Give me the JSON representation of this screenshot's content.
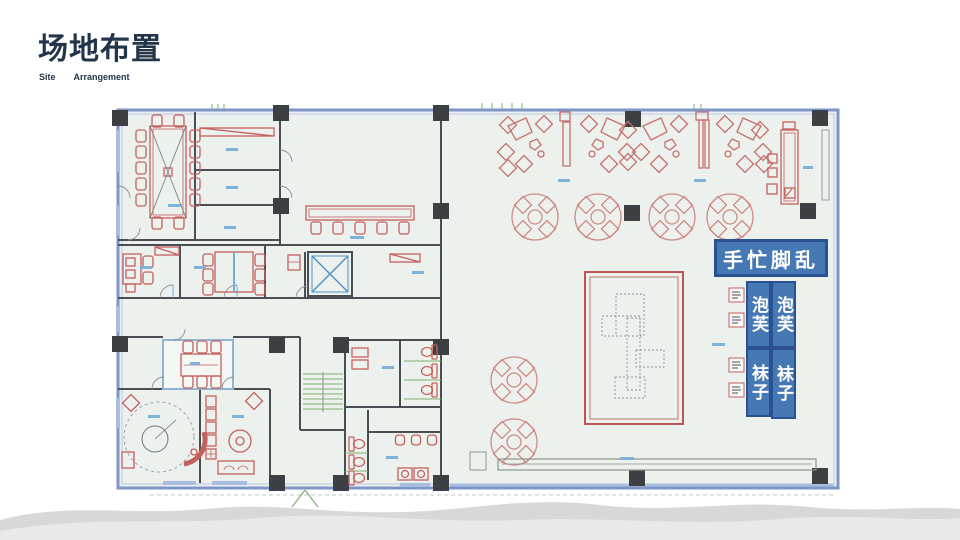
{
  "slide": {
    "title": "场地布置",
    "subtitle": {
      "left": "Site",
      "right": "Arrangement"
    }
  },
  "overlay": {
    "banner_label": "手忙脚乱",
    "booths": [
      {
        "label": "泡芙"
      },
      {
        "label": "泡芙"
      },
      {
        "label": "袜子"
      },
      {
        "label": "袜子"
      }
    ]
  },
  "colors": {
    "title_text": "#233649",
    "banner_fill": "#4679b4",
    "banner_border": "#2a5191",
    "plan_red": "#c4605c",
    "plan_wall": "#4a4e52",
    "plan_outer_blue": "#7e95c8",
    "annotation_blue": "#7fb2d9",
    "stairs_green": "#7fae6f",
    "wave_dark": "#d8d8d8",
    "wave_light": "#e9e9e9"
  }
}
